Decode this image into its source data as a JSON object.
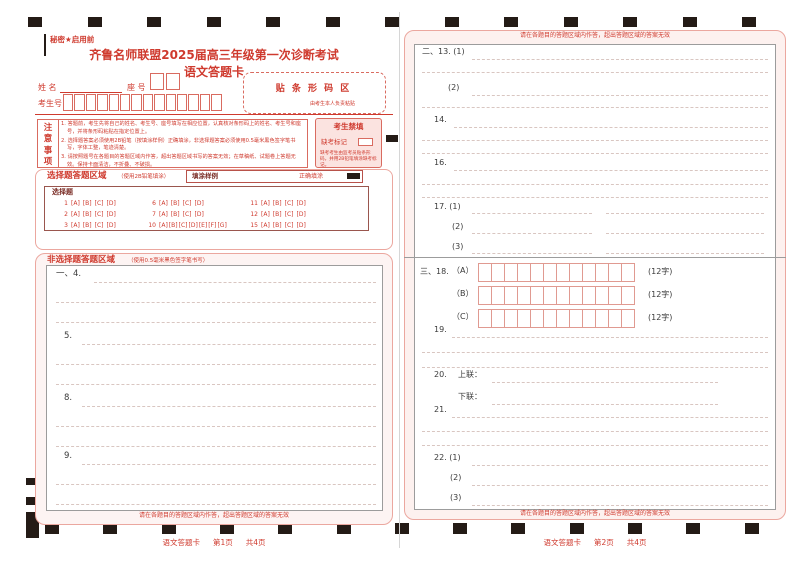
{
  "marks": {
    "top_count": 13,
    "bottom_count": 13,
    "dash_count": 28
  },
  "page1": {
    "secrecy": "秘密★启用前",
    "title": "齐鲁名师联盟2025届高三年级第一次诊断考试",
    "subtitle": "语文答题卡",
    "name_label": "姓  名",
    "seat_label": "座  号",
    "candidate_label": "考生号",
    "seat_box_count": 2,
    "candidate_box_count": 14,
    "barcode_title": "贴 条 形 码 区",
    "barcode_note": "由考生本人负责粘贴",
    "notice_label": "注意事项",
    "notice_items": [
      "1. 答题前，考生先将自己的姓名、考生号、座号填写在相应位置，认真核对条形码上的姓名、考生号和座号，并将条形码粘贴在指定位置上。",
      "2. 选择题答案必须使用2B铅笔（按填涂样例）正确填涂，非选择题答案必须使用0.5毫米黑色签字笔书写，字体工整，笔迹清楚。",
      "3. 请按照题号在各题目的答题区域内作答，超出答题区域书写的答案无效；在草稿纸、试题卷上答题无效。保持卡面清洁，不折叠、不破损。"
    ],
    "forbidden_title": "考生禁填",
    "absent_label": "缺考标记",
    "forbidden_note": "缺考考生由监考员贴条形码，并用2B铅笔填涂缺考标记。",
    "choice": {
      "title": "选择题答题区域",
      "subtitle": "（使用2B铅笔填涂）",
      "sample_label": "填涂样例",
      "correct_label": "正确填涂",
      "inner_title": "选择题",
      "rows": [
        [
          {
            "no": "1",
            "opts": [
              "A",
              "B",
              "C",
              "D"
            ]
          },
          {
            "no": "6",
            "opts": [
              "A",
              "B",
              "C",
              "D"
            ]
          },
          {
            "no": "11",
            "opts": [
              "A",
              "B",
              "C",
              "D"
            ]
          }
        ],
        [
          {
            "no": "2",
            "opts": [
              "A",
              "B",
              "C",
              "D"
            ]
          },
          {
            "no": "7",
            "opts": [
              "A",
              "B",
              "C",
              "D"
            ]
          },
          {
            "no": "12",
            "opts": [
              "A",
              "B",
              "C",
              "D"
            ]
          }
        ],
        [
          {
            "no": "3",
            "opts": [
              "A",
              "B",
              "C",
              "D"
            ]
          },
          {
            "no": "10",
            "opts": [
              "A",
              "B",
              "C",
              "D",
              "E",
              "F",
              "G"
            ]
          },
          {
            "no": "15",
            "opts": [
              "A",
              "B",
              "C",
              "D"
            ]
          }
        ]
      ]
    },
    "essay": {
      "title": "非选择题答题区域",
      "subtitle": "（使用0.5毫米黑色签字笔书写）",
      "questions": [
        {
          "label": "一、4."
        },
        {
          "label": "5."
        },
        {
          "label": "8."
        },
        {
          "label": "9."
        }
      ]
    },
    "warning": "请在各题目的答题区域内作答，超出答题区域的答案无效",
    "footer": {
      "title": "语文答题卡",
      "page": "第1页",
      "total": "共4页"
    }
  },
  "page2": {
    "warning": "请在各题目的答题区域内作答，超出答题区域的答案无效",
    "items": {
      "q13_1": "二、13. (1)",
      "q13_2": "(2)",
      "q14": "14.",
      "q16": "16.",
      "q17": {
        "label": "17. (1)",
        "l2": "(2)",
        "l3": "(3)"
      },
      "q18": {
        "section": "三、18.",
        "a": "（A）",
        "b": "（B）",
        "c": "（C）",
        "suffix": "(12字)",
        "cells": 12
      },
      "q19": "19.",
      "q20": {
        "label": "20.",
        "upper": "上联：",
        "lower": "下联："
      },
      "q21": "21.",
      "q22": {
        "label": "22. (1)",
        "l2": "(2)",
        "l3": "(3)"
      }
    },
    "footer": {
      "title": "语文答题卡",
      "page": "第2页",
      "total": "共4页"
    }
  }
}
